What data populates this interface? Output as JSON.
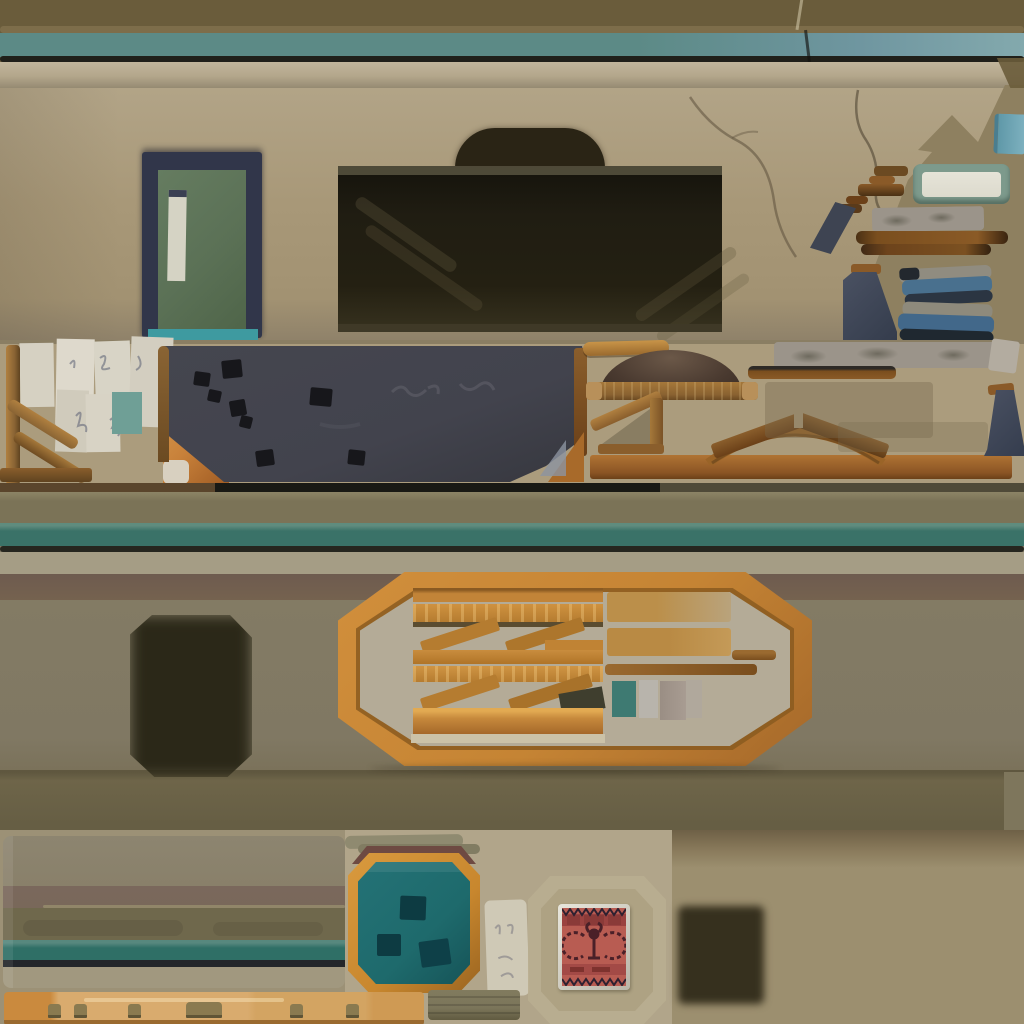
{
  "atlas": {
    "kind": "hand-painted building texture atlas sprite sheet",
    "sections": [
      {
        "name": "roof-trim-strip",
        "desc": "olive fascia with teal painted stripe and dark shadow line, crack near right"
      },
      {
        "name": "cornice-strip",
        "desc": "light beige stone cornice ledge"
      },
      {
        "name": "wall-band",
        "desc": "beige plaster wall with cracks, diagonal torn edge to olive backing at top right"
      },
      {
        "name": "green-door",
        "desc": "green service door with navy frame, narrow white window, teal threshold"
      },
      {
        "name": "garage-opening",
        "desc": "large dark interior opening with arched top and faint beam streaks"
      },
      {
        "name": "right-props",
        "desc": "blue tile, green framed box, broken step bars, stone lintel, wood beams, navy chimney wedges, stacked blue planks"
      },
      {
        "name": "shelf-band",
        "desc": "paper notes, wood stair railing, dark slate board with black patches, straw patch, awning dome on plank, wood bracket, gable arch, stone lintel, navy chimney"
      },
      {
        "name": "second-trim-band",
        "desc": "olive band, teal stripe, shadow line, light ledge, mauve shadow"
      },
      {
        "name": "crate-wall",
        "desc": "olive warehouse wall, soft dark decal blob, octagonal wood frame filled with planks, braces, tan boards and paint swatches"
      },
      {
        "name": "lower-trim-band",
        "desc": "dark olive skirting band"
      },
      {
        "name": "bottom-left-panel",
        "desc": "layered strata panel: gray-olive, mauve, olive, teal stripe, dark line, light base"
      },
      {
        "name": "teal-hatch",
        "desc": "octagonal teal hatch with orange wood frame and three dark square holes"
      },
      {
        "name": "paper-scrap",
        "desc": "small white note with scribbles"
      },
      {
        "name": "stamp-poster",
        "desc": "red propaganda stamp poster with dark zigzag borders and gear-wreath emblem, inside octagonal wall outline"
      },
      {
        "name": "dark-vent",
        "desc": "soft dark square vent decal"
      },
      {
        "name": "peg-plank",
        "desc": "light orange wooden plank with peg knobs"
      },
      {
        "name": "khaki-bar",
        "desc": "small ribbed khaki bar"
      }
    ]
  },
  "palette": {
    "trim-olive": "#6a5c3b",
    "trim-olive-light": "#8c7c58",
    "trim-teal": "#5c8a86",
    "trim-teal-blue": "#6f96a0",
    "ink": "#20201a",
    "cornice-light": "#c2b69c",
    "cornice": "#b3a68b",
    "cornice-shadow": "#958a72",
    "wall": "#a89878",
    "wall-light": "#b2a487",
    "wall-shadow": "#8d8069",
    "bg-olive": "#8e8060",
    "opening-dark": "#201d12",
    "arch-dark": "#2a2415",
    "door-navy": "#31364a",
    "door-green": "#5b7156",
    "window-white": "#d5d3c4",
    "threshold-teal": "#3e9aa0",
    "mid-bg": "#ab9c7d",
    "paper": "#d8d4c6",
    "paper-teal": "#6f9f96",
    "wood": "#8a6434",
    "wood-light": "#b08040",
    "wood-dark": "#6b4a22",
    "board": "#42434d",
    "board-black": "#17171b",
    "fur": "#c8813a",
    "dome": "#4a3a30",
    "plank-brown": "#8a6231",
    "stone": "#9b948a",
    "stone-dark": "#6e6a5e",
    "beam-brown": "#7a4e1e",
    "navy": "#3e4452",
    "bundle-blue": "#49708e",
    "bundle-gray": "#908c80",
    "box-green": "#7d9a8c",
    "box-inner": "#dcdacd",
    "tile-blue": "#7fb2c0",
    "band2-olive": "#7b7357",
    "band2-teal": "#3a7268",
    "band2-light": "#a59d85",
    "band2-mauve": "#6e5b4f",
    "main-olive": "#807863",
    "main-olive-dark": "#6e6549",
    "blob": "#2b2818",
    "frame-orange": "#c58434",
    "frame-orange-dark": "#8a5a20",
    "octa-interior": "#b4ab97",
    "plank-orange": "#c98d3e",
    "plank-orange-light": "#e2aa52",
    "tan": "#bb8f4a",
    "swatch-teal": "#3e7a72",
    "swatch-gray": "#b8b4ac",
    "swatch-taupe": "#9a8e84",
    "bottom-left-bg": "#9c9176",
    "bottom-mid-bg": "#b1a58a",
    "bottom-right-bg": "#9c8f6f",
    "panel-gray": "#89806a",
    "panel-mauve": "#7a685c",
    "panel-olive": "#6f684c",
    "panel-teal": "#2f6f66",
    "panel-light": "#a1987f",
    "hatch-teal": "#1e6a6c",
    "hatch-square": "#0d3b42",
    "hatch-frame": "#c8872e",
    "hatch-mauve": "#6e4a42",
    "poster-red": "#b85c52",
    "poster-dark": "#4a2028",
    "poster-band": "#a34a46",
    "plank-light": "#d9ab6e",
    "plank-orange2": "#ca8a3e",
    "peg": "#8a7a50",
    "khaki-bar": "#7b755a"
  }
}
